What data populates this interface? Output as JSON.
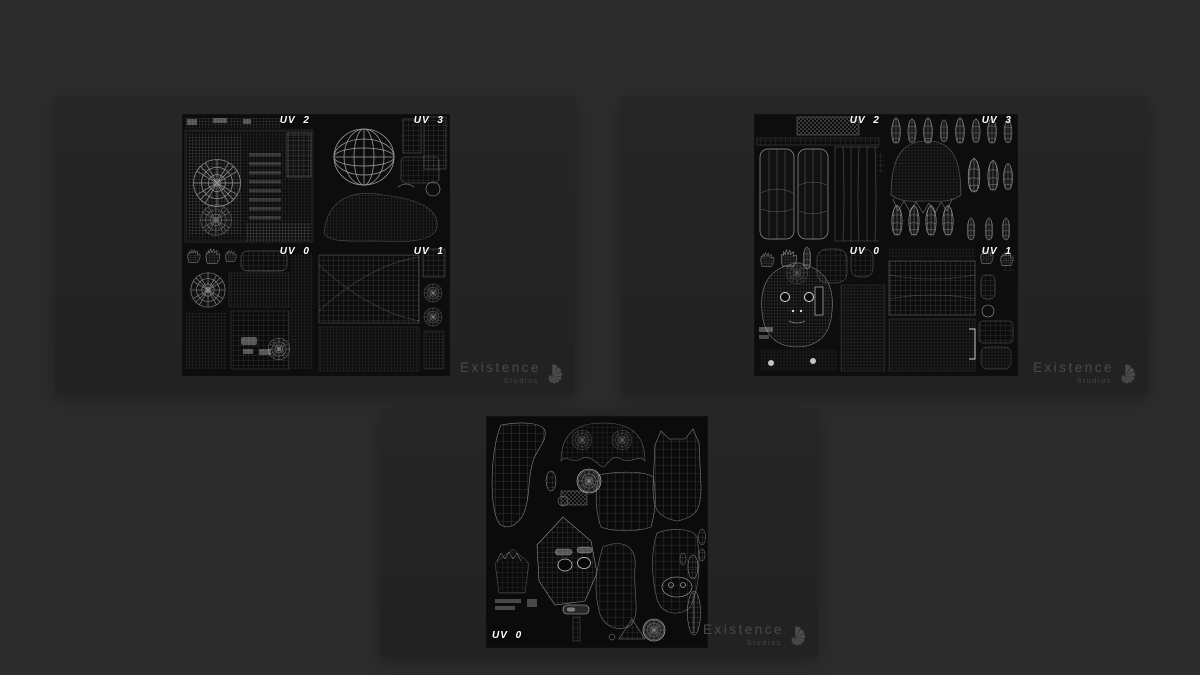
{
  "watermark": {
    "title": "Existence",
    "subtitle": "Studios"
  },
  "panels": [
    {
      "name": "left-uv-board",
      "labels": [
        "UV 2",
        "UV 3",
        "UV 0",
        "UV 1"
      ]
    },
    {
      "name": "right-uv-board",
      "labels": [
        "UV 2",
        "UV 3",
        "UV 0",
        "UV 1"
      ]
    },
    {
      "name": "bottom-uv-board",
      "labels": [
        "UV 0"
      ]
    }
  ],
  "colors": {
    "page_bg": "#2c2c2c",
    "card_bg": "#242424",
    "sheet_bg": "#0d0d0d",
    "wireframe": "#9a9a9a",
    "label": "#ffffff",
    "watermark": "#4a4a4a"
  }
}
